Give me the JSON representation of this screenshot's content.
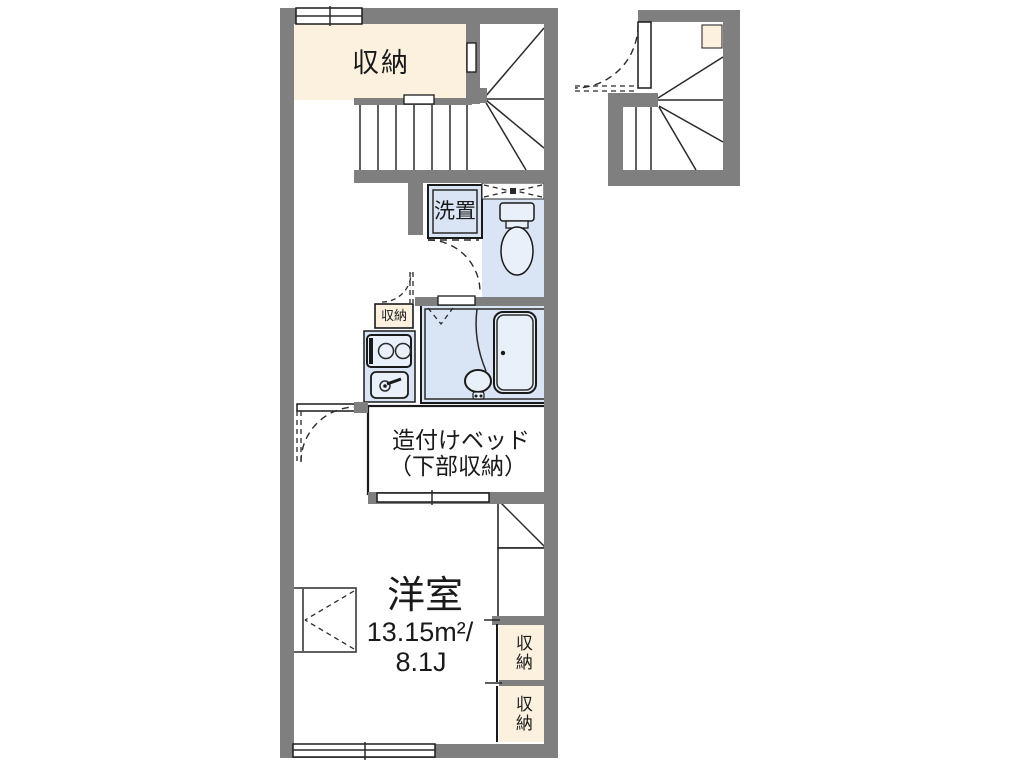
{
  "colors": {
    "wall": "#7f7f7f",
    "storage": "#fbf1de",
    "wet": "#d9e5f4",
    "fixture": "#e9f0fa",
    "floor": "#ffffff",
    "line": "#1a1a1a"
  },
  "labels": {
    "storage_top": "収納",
    "washer": "洗置",
    "storage_small": "収納",
    "bed_line1": "造付けベッド",
    "bed_line2": "（下部収納）",
    "room_name": "洋室",
    "room_area": "13.15m²/",
    "room_size": "8.1J",
    "storage_right_upper": "収納",
    "storage_right_lower": "収納"
  }
}
